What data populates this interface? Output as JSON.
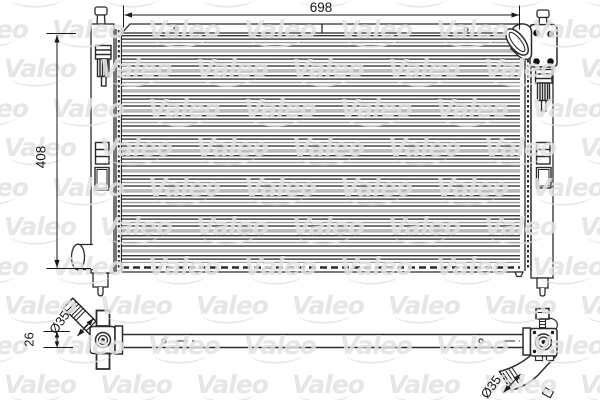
{
  "title": "Valeo radiator technical drawing",
  "watermark": {
    "text": "Valeo"
  },
  "dimensions": {
    "width": "698",
    "height": "408",
    "offset": "26",
    "pipe_left": "Ø35",
    "pipe_right": "Ø35"
  }
}
